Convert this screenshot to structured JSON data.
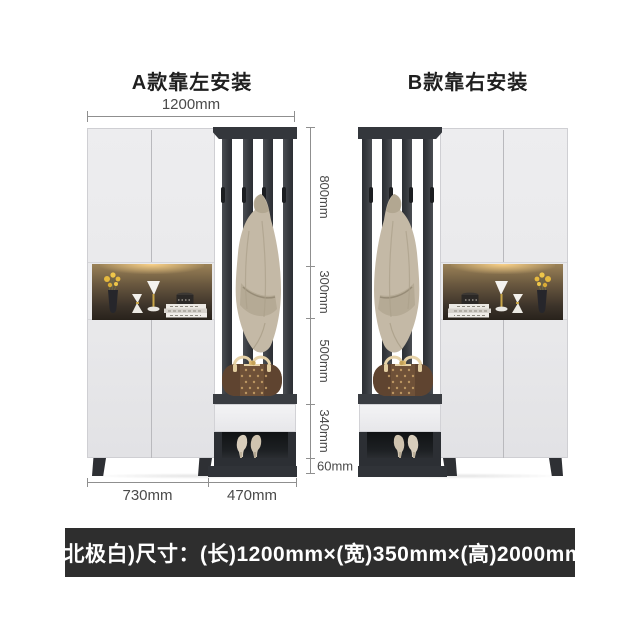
{
  "titles": {
    "model_a": "A款靠左安装",
    "model_b": "B款靠右安装"
  },
  "dimensions": {
    "top_width": "1200mm",
    "vertical": [
      "800mm",
      "300mm",
      "500mm",
      "340mm",
      "60mm"
    ],
    "bottom_left": "730mm",
    "bottom_right": "470mm"
  },
  "footer": {
    "spec_text": "(北极白)尺寸：(长)1200mm×(宽)350mm×(高)2000mm"
  },
  "colors": {
    "cabinet_white": "#ebebed",
    "frame_dark": "#34373c",
    "niche_warm_light": "#9b8257",
    "coat_beige": "#c4b9a6",
    "bag_brown": "#6f5138",
    "footer_bg": "#2e2e2e",
    "dim_line": "#8f8f8f"
  }
}
